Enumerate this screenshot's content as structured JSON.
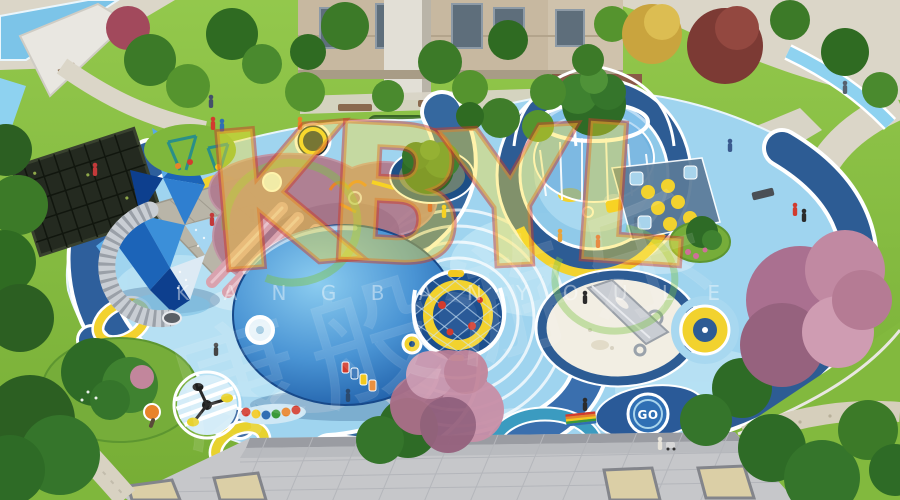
{
  "watermark": {
    "letters": [
      "K",
      "B",
      "Y",
      "L"
    ],
    "brand_roman": "K A N G B A N Y O U L E",
    "brand_cjk": "康般游乐",
    "logo_fill": "#ffe02e",
    "logo_stroke_red": "#cc3c2a",
    "logo_accent_green": "#7dbe3c"
  },
  "ground_markings": {
    "go": "GO"
  },
  "palette": {
    "lawn_green": "#84ba3e",
    "playground_base_blue": "#9fd4ef",
    "band_dark_blue": "#2e5f9c",
    "accent_yellow": "#f2d22e",
    "octopus_pink": "#b07e91",
    "whale_dome_blue": "#1d5ca6",
    "crystal_blue": "#2f7fd0",
    "plaza_gray": "#c6c7ca",
    "pavement_beige": "#dbd6c8",
    "blossom_pink": "#b57b94",
    "tree_green": "#2e6b26"
  },
  "scene": {
    "subject_elements": [
      "pergola-canopy",
      "crystal-climbing-tower",
      "spiral-tube-slide",
      "octopus-play-mound",
      "whale-dome-mound",
      "carousel-play-structure",
      "climbing-net-dome",
      "sand-pit",
      "stainless-steel-slide",
      "target-rings",
      "hopscotch-court",
      "spinner-toy",
      "caterpillar-balance-toy",
      "rainbow-bench",
      "cherry-blossom-tree",
      "plaza-pavement",
      "go-marking",
      "apartment-building",
      "water-feature",
      "pedestrians"
    ]
  }
}
